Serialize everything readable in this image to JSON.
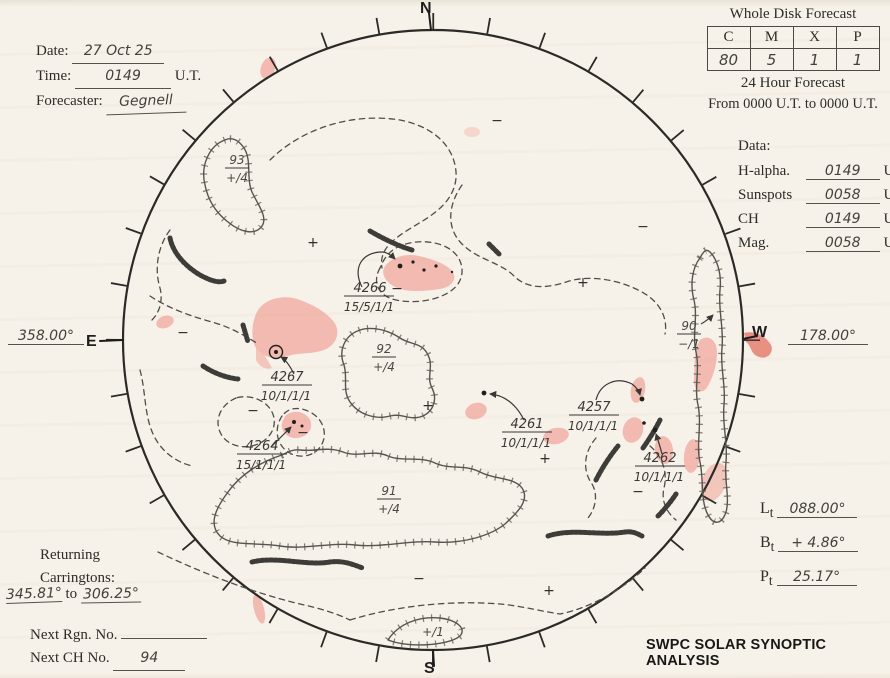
{
  "header": {
    "date_label": "Date:",
    "date_value": "27 Oct 25",
    "time_label": "Time:",
    "time_value": "0149",
    "time_unit": "U.T.",
    "forecaster_label": "Forecaster:",
    "forecaster_value": "Gegnell"
  },
  "forecast": {
    "title": "Whole Disk Forecast",
    "columns": [
      "C",
      "M",
      "X",
      "P"
    ],
    "values": [
      "80",
      "5",
      "1",
      "1"
    ],
    "subtitle": "24 Hour Forecast",
    "range": "From 0000 U.T. to 0000 U.T."
  },
  "data_section": {
    "title": "Data:",
    "rows": [
      {
        "label": "H-alpha.",
        "value": "0149",
        "unit": "U.T."
      },
      {
        "label": "Sunspots",
        "value": "0058",
        "unit": "U.T."
      },
      {
        "label": "CH",
        "value": "0149",
        "unit": "U.T."
      },
      {
        "label": "Mag.",
        "value": "0058",
        "unit": "U.T."
      }
    ]
  },
  "limb": {
    "north": "N",
    "south": "S",
    "east": "E",
    "west": "W",
    "east_longitude": "358.00°",
    "west_longitude": "178.00°"
  },
  "ephemeris": {
    "rows": [
      {
        "letter": "L",
        "sub": "t",
        "value": "088.00°"
      },
      {
        "letter": "B",
        "sub": "t",
        "value": "+ 4.86°"
      },
      {
        "letter": "P",
        "sub": "t",
        "value": "25.17°"
      }
    ]
  },
  "returning": {
    "line1": "Returning",
    "line2": "Carringtons:",
    "from": "345.81°",
    "to_word": "to",
    "to": "306.25°"
  },
  "footer": {
    "next_rgn_label": "Next Rgn. No.",
    "next_rgn_value": "",
    "next_ch_label": "Next CH No.",
    "next_ch_value": "94",
    "brand": "SWPC SOLAR SYNOPTIC ANALYSIS"
  },
  "disk": {
    "plus_sign": "+",
    "minus_sign": "−",
    "regions": [
      {
        "number": "4266",
        "counts": "15/5/1/1"
      },
      {
        "number": "4267",
        "counts": "10/1/1/1"
      },
      {
        "number": "4264",
        "counts": "15/1/1/1"
      },
      {
        "number": "4261",
        "counts": "10/1/1/1"
      },
      {
        "number": "4257",
        "counts": "10/1/1/1"
      },
      {
        "number": "4262",
        "counts": "10/1/1/1"
      }
    ],
    "coronal_holes": [
      {
        "number": "93",
        "polarity": "+/4"
      },
      {
        "number": "92",
        "polarity": "+/4"
      },
      {
        "number": "91",
        "polarity": "+/4"
      },
      {
        "number": "90",
        "polarity": "−/1"
      },
      {
        "number": "",
        "polarity": "+/1"
      }
    ]
  },
  "colors": {
    "plage_red": "#ef8d82",
    "ink": "#2b2a27"
  }
}
